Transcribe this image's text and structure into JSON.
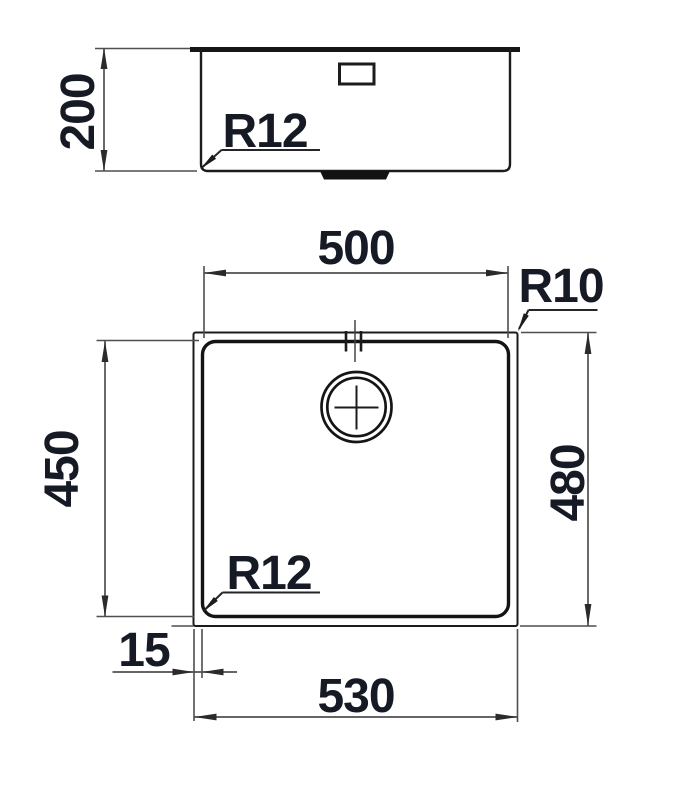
{
  "side_view": {
    "height": "200",
    "corner_radius": "R12"
  },
  "plan_view": {
    "inner_width": "500",
    "outer_corner_radius": "R10",
    "inner_depth": "450",
    "outer_depth": "480",
    "inner_corner_radius": "R12",
    "rim_offset": "15",
    "outer_width": "530"
  },
  "colors": {
    "object_line": "#1c1c1c",
    "dimension_line": "#4f4f4f",
    "label_text": "#151a24",
    "background": "#ffffff"
  }
}
